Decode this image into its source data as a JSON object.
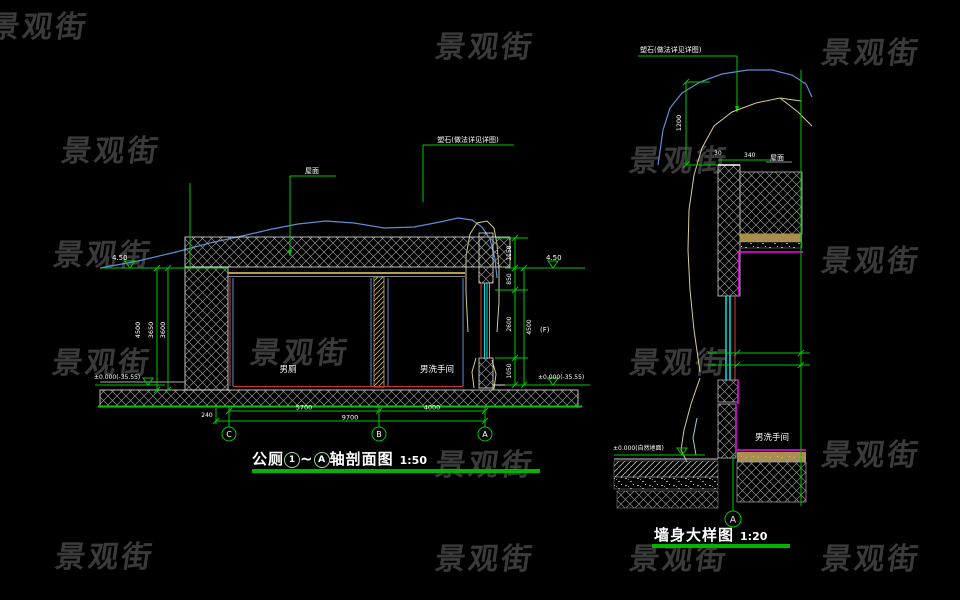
{
  "watermark": {
    "text": "景观街"
  },
  "left": {
    "title_prefix": "公厕",
    "title_axis1": "1",
    "title_tilde": "~",
    "title_axis2": "A",
    "title_suffix": "轴剖面图",
    "title_scale": "1:50",
    "room1": "男厕",
    "room2": "男洗手间",
    "leader_roof": "屋面",
    "leader_rock": "塑石(做法详见详图)",
    "elev_top_left": "4.50",
    "elev_bottom_left": "±0.000(-35.55)",
    "elev_top_right": "4.50",
    "elev_bottom_right": "±0.000(-35.55)",
    "bubble_c": "C",
    "bubble_b": "B",
    "bubble_a": "A",
    "dim_left_1": "4500",
    "dim_left_2": "3650",
    "dim_left_3": "3600",
    "dim_right_1": "1150",
    "dim_right_2": "850",
    "dim_right_3": "2600",
    "dim_right_4": "1050",
    "dim_right_total": "4500",
    "dim_right_note": "(F)",
    "dim_bot_offset": "240",
    "dim_bot_1": "5700",
    "dim_bot_2": "4000",
    "dim_bot_total": "9700"
  },
  "right": {
    "title_name": "墙身大样图",
    "title_scale": "1:20",
    "leader_rock": "塑石(做法详见详图)",
    "label_roof": "屋面",
    "dim_top_1": "30",
    "dim_top_2": "340",
    "dim_left": "1200",
    "room": "男洗手间",
    "elev_bottom": "±0.000(自然地面)",
    "bubble_a": "A"
  }
}
